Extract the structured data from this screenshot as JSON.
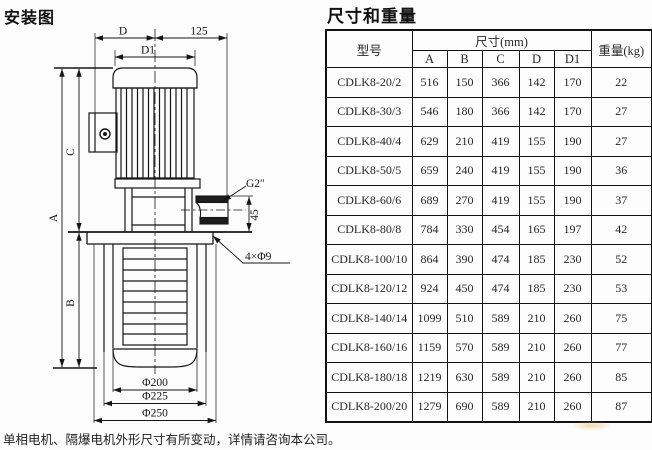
{
  "page": {
    "left_title": "安装图",
    "right_title": "尺寸和重量",
    "footer_note": "单相电机、隔爆电机外形尺寸有所变动，详情请咨询本公司。"
  },
  "diagram": {
    "labels": {
      "d": "D",
      "len125": "125",
      "d1": "D1",
      "a": "A",
      "b": "B",
      "c": "C",
      "n45": "45",
      "thread": "G2″",
      "holes": "4×Φ9",
      "phi200": "Φ200",
      "phi225": "Φ225",
      "phi250": "Φ250"
    }
  },
  "table": {
    "headers": {
      "model": "型号",
      "size_group": "尺寸(mm)",
      "col_a": "A",
      "col_b": "B",
      "col_c": "C",
      "col_d": "D",
      "col_d1": "D1",
      "weight": "重量(kg)"
    },
    "rows": [
      {
        "model": "CDLK8-20/2",
        "A": "516",
        "B": "150",
        "C": "366",
        "D": "142",
        "D1": "170",
        "weight": "22"
      },
      {
        "model": "CDLK8-30/3",
        "A": "546",
        "B": "180",
        "C": "366",
        "D": "142",
        "D1": "170",
        "weight": "27"
      },
      {
        "model": "CDLK8-40/4",
        "A": "629",
        "B": "210",
        "C": "419",
        "D": "155",
        "D1": "190",
        "weight": "27"
      },
      {
        "model": "CDLK8-50/5",
        "A": "659",
        "B": "240",
        "C": "419",
        "D": "155",
        "D1": "190",
        "weight": "36"
      },
      {
        "model": "CDLK8-60/6",
        "A": "689",
        "B": "270",
        "C": "419",
        "D": "155",
        "D1": "190",
        "weight": "37"
      },
      {
        "model": "CDLK8-80/8",
        "A": "784",
        "B": "330",
        "C": "454",
        "D": "165",
        "D1": "197",
        "weight": "42"
      },
      {
        "model": "CDLK8-100/10",
        "A": "864",
        "B": "390",
        "C": "474",
        "D": "185",
        "D1": "230",
        "weight": "52"
      },
      {
        "model": "CDLK8-120/12",
        "A": "924",
        "B": "450",
        "C": "474",
        "D": "185",
        "D1": "230",
        "weight": "53"
      },
      {
        "model": "CDLK8-140/14",
        "A": "1099",
        "B": "510",
        "C": "589",
        "D": "210",
        "D1": "260",
        "weight": "75"
      },
      {
        "model": "CDLK8-160/16",
        "A": "1159",
        "B": "570",
        "C": "589",
        "D": "210",
        "D1": "260",
        "weight": "77"
      },
      {
        "model": "CDLK8-180/18",
        "A": "1219",
        "B": "630",
        "C": "589",
        "D": "210",
        "D1": "260",
        "weight": "85"
      },
      {
        "model": "CDLK8-200/20",
        "A": "1279",
        "B": "690",
        "C": "589",
        "D": "210",
        "D1": "260",
        "weight": "87"
      }
    ]
  },
  "colors": {
    "ink": "#161616",
    "paper": "#fcfcfc",
    "table_border": "#111111"
  }
}
